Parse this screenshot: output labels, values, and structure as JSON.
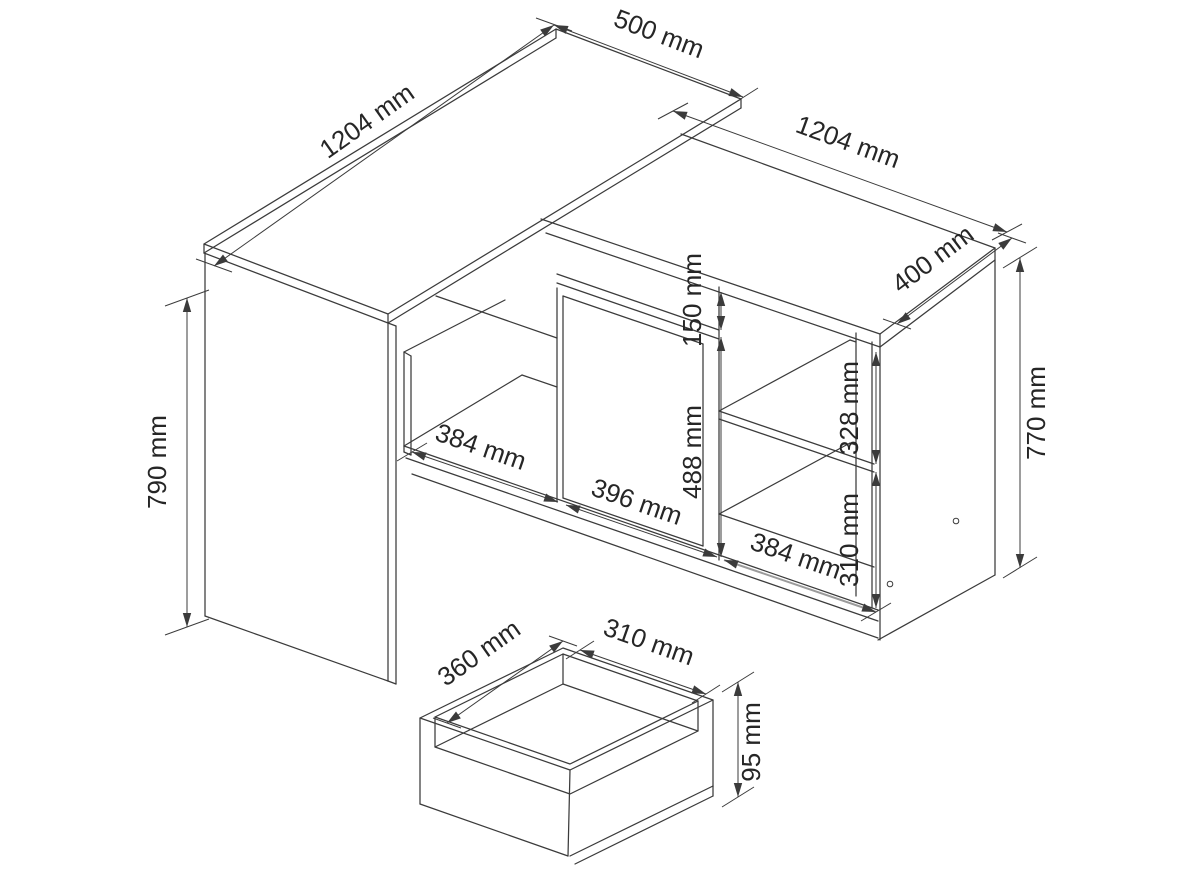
{
  "figure": {
    "background": "#ffffff",
    "line_color": "#3b3b3b",
    "gray_dim_color": "#9b9b9b",
    "text_color": "#262626"
  },
  "dimensions": {
    "desk_top_length": "1204 mm",
    "desk_top_depth": "500 mm",
    "desk_height": "790 mm",
    "cabinet_length": "1204 mm",
    "cabinet_depth": "400 mm",
    "cabinet_height": "770 mm",
    "drawer_front_height": "150 mm",
    "door_height": "488 mm",
    "upper_shelf_opening_height": "328 mm",
    "lower_shelf_opening_height": "310 mm",
    "left_niche_width": "384 mm",
    "door_width": "396 mm",
    "right_section_width": "384 mm",
    "drawer_box_depth": "360 mm",
    "drawer_box_width": "310 mm",
    "drawer_box_height": "95 mm"
  }
}
